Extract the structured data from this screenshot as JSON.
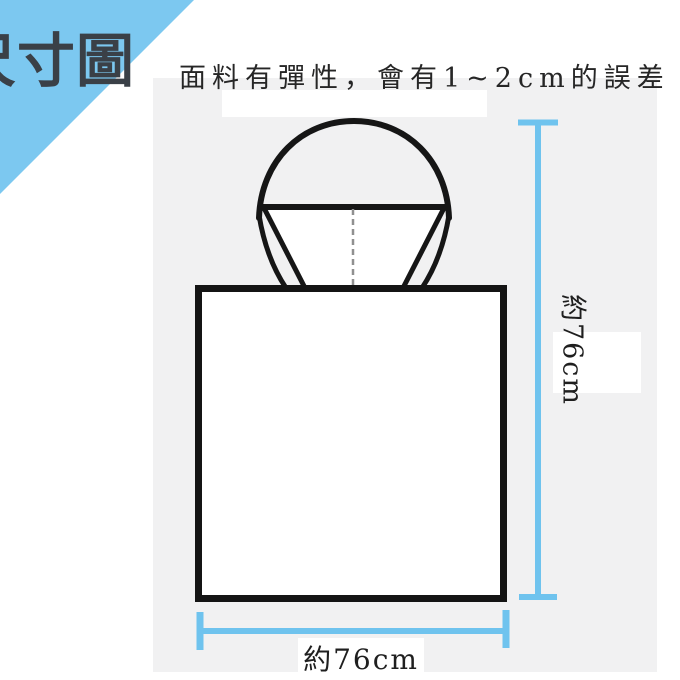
{
  "banner": {
    "title": "尺寸圖"
  },
  "note": "面料有彈性，會有1~2cm的誤差",
  "diagram": {
    "subject": "hooded-poncho-outline",
    "width_label": "約76cm",
    "height_label": "約76cm"
  },
  "colors": {
    "banner_blue": "#7cc8f0",
    "dimension_blue": "#6fc3ee",
    "panel_gray": "#f1f1f2",
    "outline_black": "#161616",
    "seam_gray": "#909090",
    "title_color": "#3a4047",
    "text_color": "#262626"
  }
}
